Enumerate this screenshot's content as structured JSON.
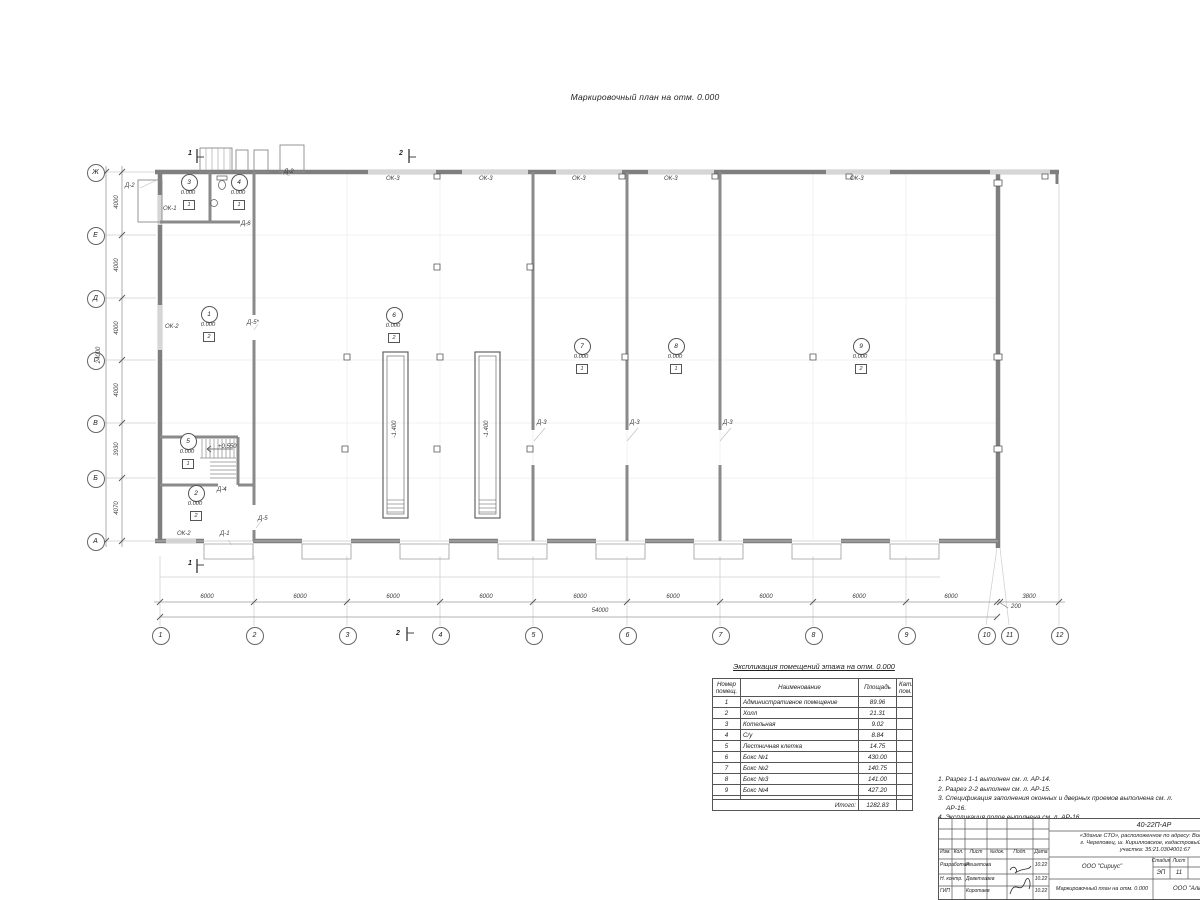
{
  "page": {
    "title": "Маркировочный план на отм. 0.000"
  },
  "plan": {
    "axis_letters": [
      {
        "l": "Ж",
        "y": 172
      },
      {
        "l": "Е",
        "y": 235
      },
      {
        "l": "Д",
        "y": 298
      },
      {
        "l": "Г",
        "y": 360
      },
      {
        "l": "В",
        "y": 423
      },
      {
        "l": "Б",
        "y": 478
      },
      {
        "l": "А",
        "y": 541
      }
    ],
    "axis_numbers": [
      {
        "l": "1",
        "x": 160,
        "gx": 160
      },
      {
        "l": "2",
        "x": 254,
        "gx": 254
      },
      {
        "l": "3",
        "x": 347,
        "gx": 347
      },
      {
        "l": "4",
        "x": 440,
        "gx": 440
      },
      {
        "l": "5",
        "x": 533,
        "gx": 533
      },
      {
        "l": "6",
        "x": 627,
        "gx": 627
      },
      {
        "l": "7",
        "x": 720,
        "gx": 720
      },
      {
        "l": "8",
        "x": 813,
        "gx": 813
      },
      {
        "l": "9",
        "x": 906,
        "gx": 906
      },
      {
        "l": "10",
        "x": 986,
        "gx": 997,
        "leader": true
      },
      {
        "l": "11",
        "x": 1009,
        "gx": 1000,
        "leader": true
      },
      {
        "l": "12",
        "x": 1059,
        "gx": 1059,
        "ytop": 184
      }
    ],
    "dims_vertical": [
      {
        "t": "4000",
        "y": 203
      },
      {
        "t": "4000",
        "y": 266
      },
      {
        "t": "4000",
        "y": 329
      },
      {
        "t": "4000",
        "y": 391
      },
      {
        "t": "3930",
        "y": 450
      },
      {
        "t": "4070",
        "y": 509
      }
    ],
    "dim_vertical_total": {
      "t": "24000",
      "y": 356
    },
    "dims_horizontal": [
      {
        "t": "6000",
        "x": 207
      },
      {
        "t": "6000",
        "x": 300
      },
      {
        "t": "6000",
        "x": 393
      },
      {
        "t": "6000",
        "x": 486
      },
      {
        "t": "6000",
        "x": 580
      },
      {
        "t": "6000",
        "x": 673
      },
      {
        "t": "6000",
        "x": 766
      },
      {
        "t": "6000",
        "x": 859
      },
      {
        "t": "6000",
        "x": 951
      },
      {
        "t": "3800",
        "x": 1029
      }
    ],
    "dim_horizontal_total": {
      "t": "54000",
      "x": 600
    },
    "dim_offset": {
      "t": "200",
      "x": 1011,
      "y": 604
    },
    "room_tags": [
      {
        "n": "1",
        "x": 208,
        "y": 313,
        "elev": "0.000",
        "f": "2"
      },
      {
        "n": "2",
        "x": 195,
        "y": 492,
        "elev": "0.000",
        "f": "2"
      },
      {
        "n": "3",
        "x": 188,
        "y": 181,
        "elev": "0.000",
        "f": "1"
      },
      {
        "n": "4",
        "x": 238,
        "y": 181,
        "elev": "0.000",
        "f": "1"
      },
      {
        "n": "5",
        "x": 187,
        "y": 440,
        "elev": "0.000",
        "f": "1"
      },
      {
        "n": "6",
        "x": 393,
        "y": 314,
        "elev": "0.000",
        "f": "2"
      },
      {
        "n": "7",
        "x": 581,
        "y": 345,
        "elev": "0.000",
        "f": "1"
      },
      {
        "n": "8",
        "x": 675,
        "y": 345,
        "elev": "0.000",
        "f": "1"
      },
      {
        "n": "9",
        "x": 860,
        "y": 345,
        "elev": "0.000",
        "f": "2"
      }
    ],
    "labels": [
      {
        "t": "ОК-3",
        "x": 386,
        "y": 176
      },
      {
        "t": "ОК-3",
        "x": 479,
        "y": 176
      },
      {
        "t": "ОК-3",
        "x": 572,
        "y": 176
      },
      {
        "t": "ОК-3",
        "x": 664,
        "y": 176
      },
      {
        "t": "ОК-3",
        "x": 850,
        "y": 176
      },
      {
        "t": "Д-2",
        "x": 125,
        "y": 183
      },
      {
        "t": "Д-2",
        "x": 284,
        "y": 169
      },
      {
        "t": "ОК-1",
        "x": 163,
        "y": 206
      },
      {
        "t": "Д-6",
        "x": 241,
        "y": 221
      },
      {
        "t": "ОК-2",
        "x": 165,
        "y": 324
      },
      {
        "t": "Д-5*",
        "x": 247,
        "y": 320
      },
      {
        "t": "+0.550",
        "x": 218,
        "y": 444
      },
      {
        "t": "Д-4",
        "x": 217,
        "y": 487
      },
      {
        "t": "Д-5",
        "x": 258,
        "y": 516
      },
      {
        "t": "ОК-2",
        "x": 177,
        "y": 531
      },
      {
        "t": "Д-1",
        "x": 220,
        "y": 531
      },
      {
        "t": "Д-3",
        "x": 537,
        "y": 420
      },
      {
        "t": "Д-3",
        "x": 630,
        "y": 420
      },
      {
        "t": "Д-3",
        "x": 723,
        "y": 420
      }
    ],
    "pit_labels": [
      {
        "t": "-1.400",
        "x": 395,
        "y": 430
      },
      {
        "t": "-1.400",
        "x": 487,
        "y": 430
      }
    ],
    "section_marks": [
      {
        "t": "1",
        "x": 188,
        "y": 150
      },
      {
        "t": "1",
        "x": 188,
        "y": 560
      },
      {
        "t": "2",
        "x": 399,
        "y": 150
      },
      {
        "t": "2",
        "x": 396,
        "y": 630
      }
    ]
  },
  "explication": {
    "title": "Экспликация помещений этажа на отм. 0.000",
    "headers": [
      "Номер помещ.",
      "Наименование",
      "Площадь",
      "Кат. пом."
    ],
    "rows": [
      [
        "1",
        "Административное помещение",
        "89.96",
        ""
      ],
      [
        "2",
        "Холл",
        "21.31",
        ""
      ],
      [
        "3",
        "Котельная",
        "9.02",
        ""
      ],
      [
        "4",
        "С/у",
        "8.84",
        ""
      ],
      [
        "5",
        "Лестничная клетка",
        "14.75",
        ""
      ],
      [
        "6",
        "Бокс №1",
        "430.00",
        ""
      ],
      [
        "7",
        "Бокс №2",
        "140.75",
        ""
      ],
      [
        "8",
        "Бокс №3",
        "141.00",
        ""
      ],
      [
        "9",
        "Бокс №4",
        "427.20",
        ""
      ]
    ],
    "total_label": "Итого:",
    "total_value": "1282.83"
  },
  "notes": [
    "1. Разрез 1-1 выполнен см. л. АР-14.",
    "2. Разрез 2-2 выполнен см. л. АР-15.",
    "3. Спецификация заполнения оконных и дверных проемов выполнена см. л. АР-16.",
    "4. Экспликация полов выполнена см. л. АР-16."
  ],
  "titleblock": {
    "doc_number": "40-22П-АР",
    "object_line1": "«Здание СТО», расположенное по адресу: Вологодская о",
    "object_line2": "г. Череповец, ш. Кирилловское, кадастровый номер зем",
    "object_line3": "участка: 35:21.0304001:67",
    "columns": [
      "Изм.",
      "Кол.",
      "Лист",
      "№док.",
      "Подп.",
      "Дата"
    ],
    "rows": [
      {
        "role": "Разработал",
        "name": "Решетова",
        "date": "10.22"
      },
      {
        "role": "Н. контр.",
        "name": "Деветгазев",
        "date": "10.22"
      },
      {
        "role": "ГИП",
        "name": "Коротаев",
        "date": "10.22"
      }
    ],
    "company": "ООО \"Сириус\"",
    "stage_label": "Стадия",
    "sheet_label": "Лист",
    "stage": "ЭП",
    "sheet": "11",
    "sheet_title": "Маркировочный план на отм. 0.000",
    "firm": "ООО \"Аль"
  }
}
